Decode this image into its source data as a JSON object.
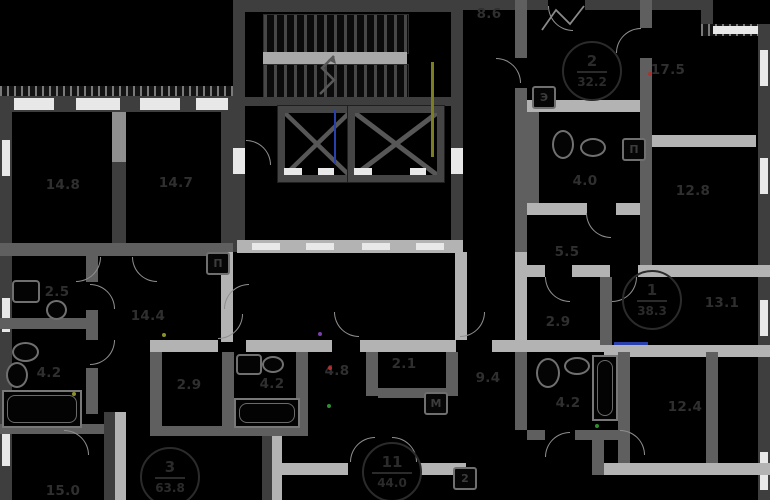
{
  "plan": {
    "kind": "residential-floor-plan",
    "colors": {
      "background": "#000000",
      "wall_dark": "#3e3e3e",
      "wall_mid": "#5f5f5f",
      "wall_light": "#b3b3b3",
      "window": "#e8e8e8",
      "label": "#2f2f2f",
      "pipe_olive": "#7d7d22",
      "elevator_blue": "#2a3fae",
      "marker_red": "#b03030",
      "marker_green": "#2f8f2f",
      "marker_yellow": "#8f8f2a",
      "marker_purple": "#7a3fae"
    }
  },
  "rooms": [
    {
      "label": "14.8"
    },
    {
      "label": "14.7"
    },
    {
      "label": "8.6"
    },
    {
      "label": "17.5"
    },
    {
      "label": "4.0"
    },
    {
      "label": "12.8"
    },
    {
      "label": "5.5"
    },
    {
      "label": "2.5"
    },
    {
      "label": "14.4"
    },
    {
      "label": "2.9"
    },
    {
      "label": "13.1"
    },
    {
      "label": "4.2"
    },
    {
      "label": "2.9"
    },
    {
      "label": "4.2"
    },
    {
      "label": "4.8"
    },
    {
      "label": "2.1"
    },
    {
      "label": "9.4"
    },
    {
      "label": "4.2"
    },
    {
      "label": "12.4"
    },
    {
      "label": "15.0"
    }
  ],
  "apartments": [
    {
      "number": "2",
      "area": "32.2"
    },
    {
      "number": "1",
      "area": "38.3"
    },
    {
      "number": "3",
      "area": "63.8"
    },
    {
      "number": "11",
      "area": "44.0"
    }
  ],
  "risers": [
    {
      "glyph": "Э"
    },
    {
      "glyph": "П"
    },
    {
      "glyph": "П"
    },
    {
      "glyph": "М"
    },
    {
      "glyph": "2"
    }
  ]
}
